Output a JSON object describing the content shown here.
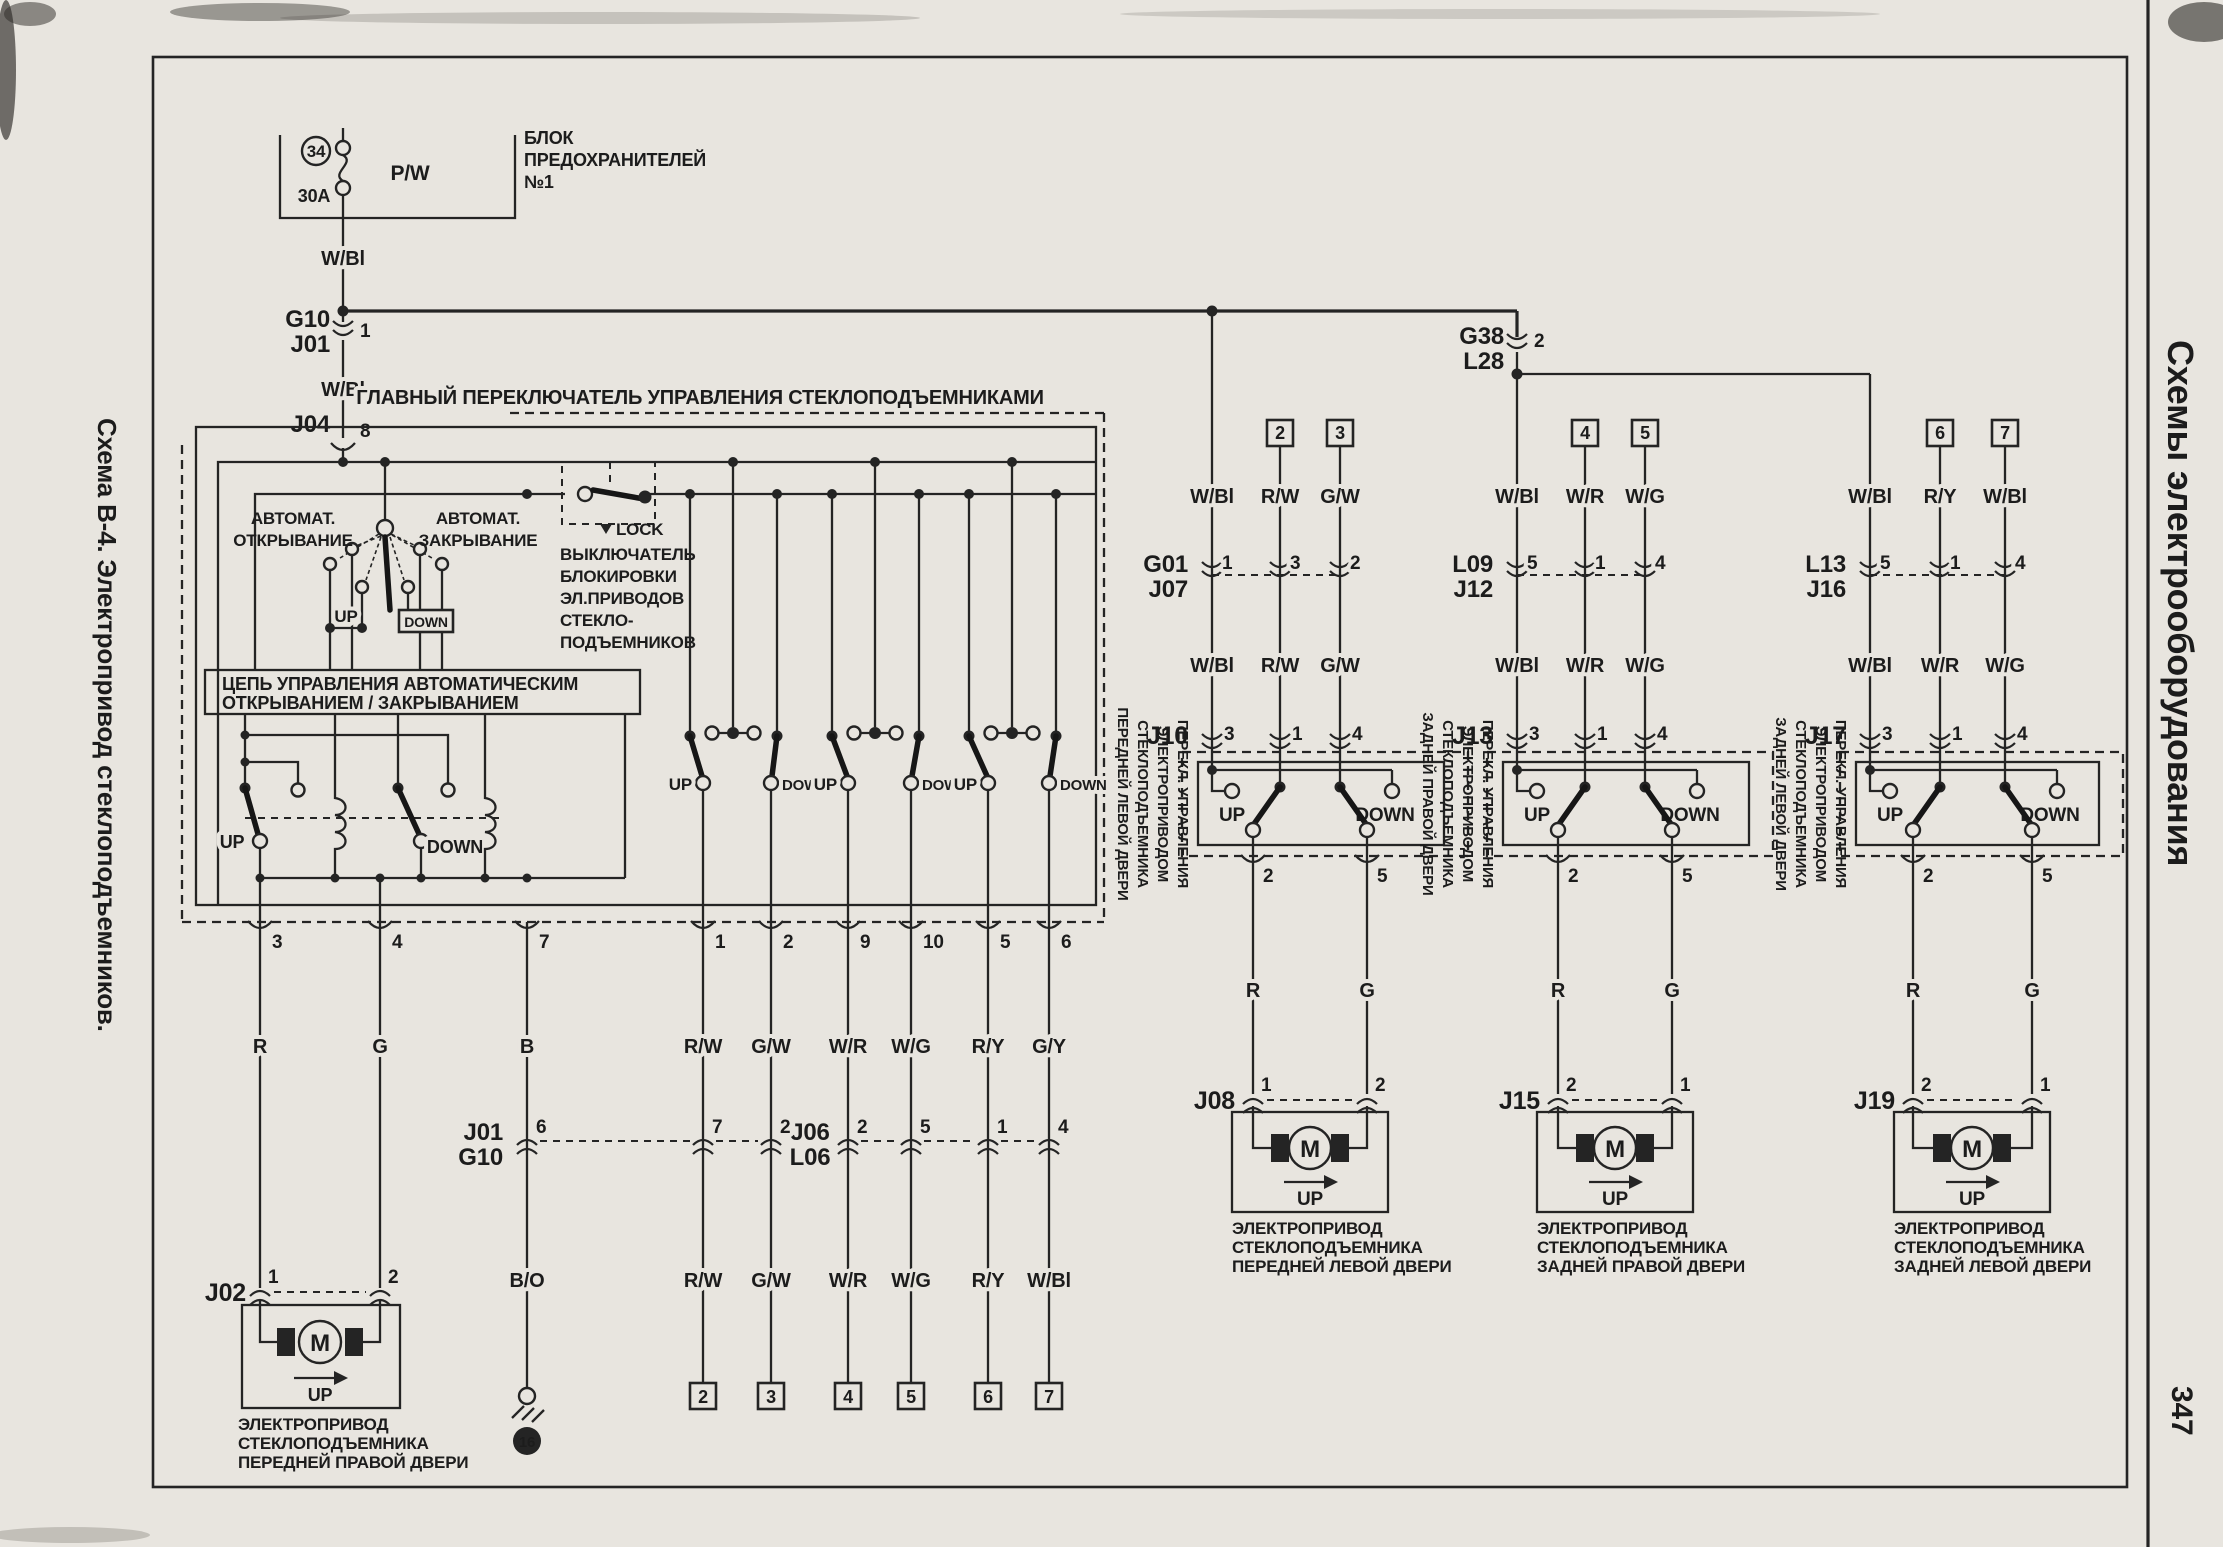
{
  "margins": {
    "left_title": "Схема В-4. Электропривод стеклоподъемников.",
    "right_title": "Схемы электрооборудования",
    "page_number": "347"
  },
  "fuse": {
    "num": "34",
    "amp": "30A",
    "wire": "P/W",
    "block1": "БЛОК",
    "block2": "ПРЕДОХРАНИТЕЛЕЙ",
    "block3": "№1"
  },
  "wires": {
    "wbl": "W/Bl",
    "rw": "R/W",
    "gw": "G/W",
    "wr": "W/R",
    "wg": "W/G",
    "ry": "R/Y",
    "gy": "G/Y",
    "r": "R",
    "g": "G",
    "b": "B",
    "bo": "B/O"
  },
  "conn": {
    "g10_top": {
      "a": "G10",
      "b": "J01",
      "pin": "1"
    },
    "j04": {
      "a": "J04",
      "pin": "8"
    },
    "g38": {
      "a": "G38",
      "b": "L28",
      "pin": "2"
    },
    "j01_mid": {
      "a": "J01",
      "b": "G10"
    },
    "j06": {
      "a": "J06",
      "b": "L06"
    },
    "row_pins": [
      "6",
      "7",
      "2",
      "2",
      "5",
      "1",
      "4"
    ],
    "j02": {
      "a": "J02",
      "p1": "1",
      "p2": "2"
    }
  },
  "main_switch": {
    "title": "ГЛАВНЫЙ ПЕРЕКЛЮЧАТЕЛЬ УПРАВЛЕНИЯ СТЕКЛОПОДЪЕМНИКАМИ",
    "auto_open1": "АВТОМАТ.",
    "auto_open2": "ОТКРЫВАНИЕ",
    "auto_close1": "АВТОМАТ.",
    "auto_close2": "ЗАКРЫВАНИЕ",
    "up": "UP",
    "down": "DOWN",
    "ctl1": "ЦЕПЬ УПРАВЛЕНИЯ АВТОМАТИЧЕСКИМ",
    "ctl2": "ОТКРЫВАНИЕМ / ЗАКРЫВАНИЕМ",
    "lock": "LOCK",
    "lock_text": [
      "ВЫКЛЮЧАТЕЛЬ",
      "БЛОКИРОВКИ",
      "ЭЛ.ПРИВОДОВ",
      "СТЕКЛО-",
      "ПОДЪЕМНИКОВ"
    ],
    "pins": [
      "3",
      "4",
      "7",
      "1",
      "2",
      "9",
      "10",
      "5",
      "6"
    ],
    "colors": [
      "R",
      "G",
      "B",
      "R/W",
      "G/W",
      "W/R",
      "W/G",
      "R/Y",
      "G/Y"
    ]
  },
  "bottom": {
    "colors": [
      "B/O",
      "R/W",
      "G/W",
      "W/R",
      "W/G",
      "R/Y",
      "W/Bl"
    ],
    "boxes": [
      "2",
      "3",
      "4",
      "5",
      "6",
      "7"
    ],
    "ground": "16"
  },
  "j02_motor": {
    "m": "M",
    "up": "UP",
    "cap": [
      "ЭЛЕКТРОПРИВОД",
      "СТЕКЛОПОДЪЕМНИКА",
      "ПЕРЕДНЕЙ ПРАВОЙ ДВЕРИ"
    ]
  },
  "groups": [
    {
      "boxes": [
        "2",
        "3"
      ],
      "colors_top": [
        "W/Bl",
        "R/W",
        "G/W"
      ],
      "c1a": "G01",
      "c1b": "J07",
      "c1p": [
        "1",
        "3",
        "2"
      ],
      "colors_mid": [
        "W/Bl",
        "R/W",
        "G/W"
      ],
      "c2": "J10",
      "c2p": [
        "3",
        "1",
        "4"
      ],
      "sw": [
        "ПЕРЕКЛ. УПРАВЛЕНИЯ",
        "ЭЛЕКТРОПРИВОДОМ",
        "СТЕКЛОПОДЪЕМНИКА",
        "ПЕРЕДНЕЙ ЛЕВОЙ ДВЕРИ"
      ],
      "up": "UP",
      "down": "DOWN",
      "op": [
        "2",
        "5"
      ],
      "mcolors": [
        "R",
        "G"
      ],
      "c3": "J08",
      "c3p": [
        "1",
        "2"
      ],
      "m": "M",
      "mup": "UP",
      "cap": [
        "ЭЛЕКТРОПРИВОД",
        "СТЕКЛОПОДЪЕМНИКА",
        "ПЕРЕДНЕЙ ЛЕВОЙ ДВЕРИ"
      ]
    },
    {
      "boxes": [
        "4",
        "5"
      ],
      "colors_top": [
        "W/Bl",
        "W/R",
        "W/G"
      ],
      "c1a": "L09",
      "c1b": "J12",
      "c1p": [
        "5",
        "1",
        "4"
      ],
      "colors_mid": [
        "W/Bl",
        "W/R",
        "W/G"
      ],
      "c2": "J13",
      "c2p": [
        "3",
        "1",
        "4"
      ],
      "sw": [
        "ПЕРЕКЛ. УПРАВЛЕНИЯ",
        "ЭЛЕКТРОПРИВОДОМ",
        "СТЕКЛОПОДЪЕМНИКА",
        "ЗАДНЕЙ ПРАВОЙ ДВЕРИ"
      ],
      "up": "UP",
      "down": "DOWN",
      "op": [
        "2",
        "5"
      ],
      "mcolors": [
        "R",
        "G"
      ],
      "c3": "J15",
      "c3p": [
        "2",
        "1"
      ],
      "m": "M",
      "mup": "UP",
      "cap": [
        "ЭЛЕКТРОПРИВОД",
        "СТЕКЛОПОДЪЕМНИКА",
        "ЗАДНЕЙ ПРАВОЙ ДВЕРИ"
      ]
    },
    {
      "boxes": [
        "6",
        "7"
      ],
      "colors_top": [
        "W/Bl",
        "R/Y",
        "W/Bl"
      ],
      "c1a": "L13",
      "c1b": "J16",
      "c1p": [
        "5",
        "1",
        "4"
      ],
      "colors_mid": [
        "W/Bl",
        "W/R",
        "W/G"
      ],
      "c2": "J17",
      "c2p": [
        "3",
        "1",
        "4"
      ],
      "sw": [
        "ПЕРЕКЛ. УПРАВЛЕНИЯ",
        "ЭЛЕКТРОПРИВОДОМ",
        "СТЕКЛОПОДЪЕМНИКА",
        "ЗАДНЕЙ ЛЕВОЙ ДВЕРИ"
      ],
      "up": "UP",
      "down": "DOWN",
      "op": [
        "2",
        "5"
      ],
      "mcolors": [
        "R",
        "G"
      ],
      "c3": "J19",
      "c3p": [
        "2",
        "1"
      ],
      "m": "M",
      "mup": "UP",
      "cap": [
        "ЭЛЕКТРОПРИВОД",
        "СТЕКЛОПОДЪЕМНИКА",
        "ЗАДНЕЙ ЛЕВОЙ ДВЕРИ"
      ]
    }
  ]
}
